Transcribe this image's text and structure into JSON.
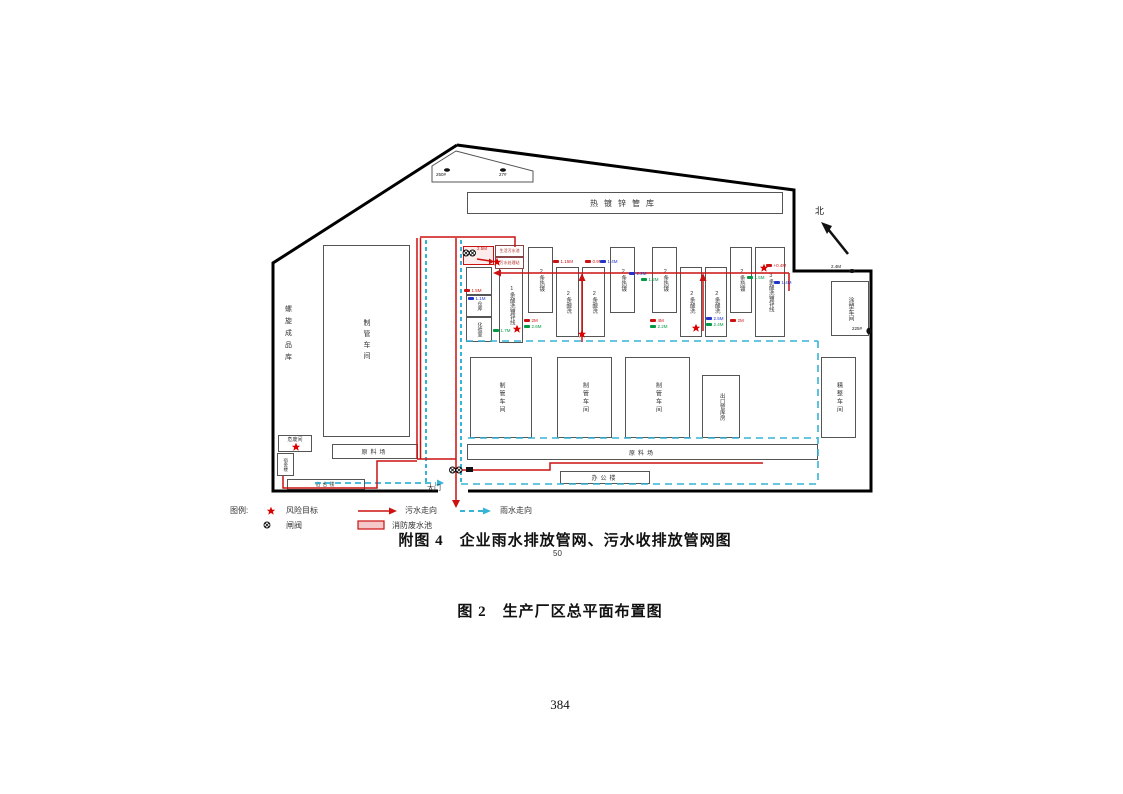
{
  "labels": {
    "paint_workshop": "喷漆车间",
    "galv_pipe_store": "热镀锌管库",
    "spiral_store": "螺旋成品库",
    "pipe_workshop": "制管车间",
    "domestic_sewage_pool": "生活污水池",
    "sewage_treatment": "污水处理站",
    "warehouse": "仓库",
    "lab": "化验室",
    "line1": "1条酸洗镀锌线",
    "hot_galv_2": "2条热镀",
    "pickling_2": "2条酸洗",
    "line3": "3条酸洗镀锌线",
    "coating_workshop": "涂塑车间",
    "export_pipe_store": "出口管库房",
    "finishing_workshop": "精整车间",
    "raw_material_yard": "原料场",
    "office_building": "办公楼",
    "dormitory": "宿舍楼",
    "hazardous_waste_room": "危废间",
    "gate": "大门",
    "north": "北"
  },
  "legend": {
    "title": "图例:",
    "risk_target": "风险目标",
    "gate_valve": "闸阀",
    "sewage_flow": "污水走向",
    "fire_wastewater_pool": "消防废水池",
    "rain_flow": "雨水走向"
  },
  "captions": {
    "figure4": "附图 4　企业雨水排放管网、污水收排放管网图",
    "figure4_footnote": "50",
    "figure2": "图 2　生产厂区总平面布置图",
    "page_number": "384"
  },
  "markers": [
    {
      "t": "2.5M",
      "c": "red"
    },
    {
      "t": "1.5M",
      "c": "red"
    },
    {
      "t": "1.1M",
      "c": "blue"
    },
    {
      "t": "1.7M",
      "c": "green"
    },
    {
      "t": "2M",
      "c": "red"
    },
    {
      "t": "2.6M",
      "c": "green"
    },
    {
      "t": "1.15M",
      "c": "red"
    },
    {
      "t": "0.9M",
      "c": "red"
    },
    {
      "t": "1.4M",
      "c": "blue"
    },
    {
      "t": "2.2M",
      "c": "blue"
    },
    {
      "t": "1.2M",
      "c": "green"
    },
    {
      "t": "4M",
      "c": "red"
    },
    {
      "t": "2.2M",
      "c": "green"
    },
    {
      "t": "2.5M",
      "c": "blue"
    },
    {
      "t": "2.4M",
      "c": "green"
    },
    {
      "t": "2M",
      "c": "red"
    },
    {
      "t": "1.5M",
      "c": "green"
    },
    {
      "t": "1.4M",
      "c": "blue"
    },
    {
      "t": "+0.4M",
      "c": "red"
    },
    {
      "t": "2.4M",
      "c": "black"
    },
    {
      "t": "225#",
      "c": "black"
    },
    {
      "t": "250#",
      "c": "black"
    },
    {
      "t": "27#",
      "c": "black"
    }
  ],
  "colors": {
    "sewage_line": "#cc1111",
    "rain_line": "#35b4d6",
    "marker_green": "#009a44",
    "marker_blue": "#2233cc",
    "risk_star": "#dd0000",
    "boundary": "#000000"
  }
}
